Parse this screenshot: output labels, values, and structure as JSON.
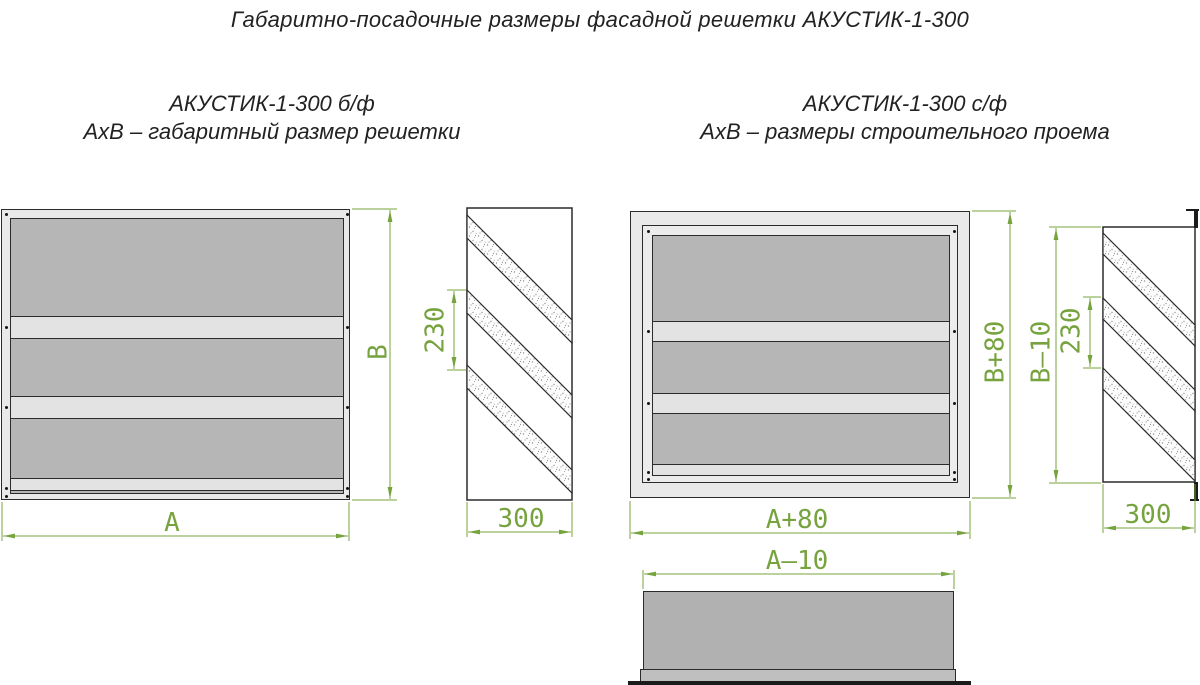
{
  "title": "Габаритно-посадочные размеры фасадной решетки АКУСТИК-1-300",
  "variants": {
    "left": {
      "name": "АКУСТИК-1-300 б/ф",
      "caption": "АхВ – габаритный размер решетки",
      "dims": {
        "width": "А",
        "height": "В",
        "pitch": "230",
        "depth": "300"
      }
    },
    "right": {
      "name": "АКУСТИК-1-300 с/ф",
      "caption": "АхВ – размеры строительного проема",
      "dims": {
        "width": "А+80",
        "height": "В+80",
        "body_height": "В–10",
        "pitch": "230",
        "depth": "300",
        "body_width": "А–10"
      }
    }
  },
  "colors": {
    "dimension_green": "#77a33e",
    "frame_light": "#e9e9e9",
    "panel_gray": "#b6b6b6",
    "bar_light": "#e3e3e3",
    "outline_dark": "#2b2b2b"
  }
}
